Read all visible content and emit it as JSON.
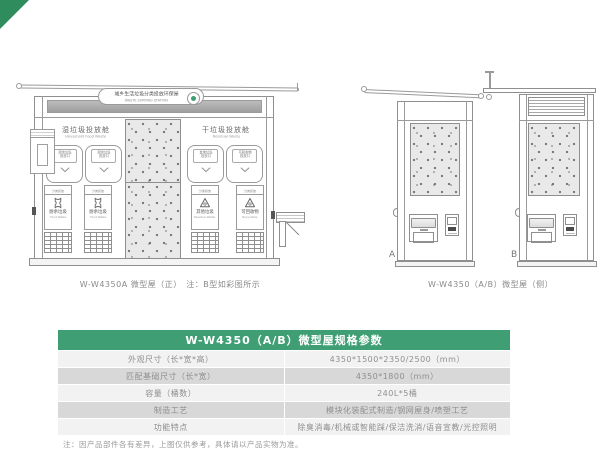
{
  "colors": {
    "accent_green": "#3f9e73",
    "corner_green": "#2f8c5c"
  },
  "drawing": {
    "front_view": {
      "sign": {
        "title": "城乡生活垃圾分类投放环保屋",
        "subtitle": "WASTE SORTING STATION"
      },
      "sections": [
        {
          "title": "湿垃圾投放舱",
          "subtitle": "Household Food Waste"
        },
        {
          "title": "干垃圾投放舱",
          "subtitle": "Residual Waste"
        }
      ],
      "doors": [
        "厨余垃圾投放口",
        "厨余垃圾投放口",
        "其他垃圾投放口",
        "可回收物投放口"
      ],
      "bins": [
        {
          "header": "分类投放",
          "name": "厨余垃圾",
          "name_en": "Food Waste"
        },
        {
          "header": "分类投放",
          "name": "厨余垃圾",
          "name_en": "Food Waste"
        },
        {
          "header": "分类投放",
          "name": "其他垃圾",
          "name_en": "Residual Waste"
        },
        {
          "header": "分类投放",
          "name": "可回收物",
          "name_en": "Recyclable"
        }
      ],
      "caption": "W-W4350A 微型屋（正）　注：B型如彩图所示"
    },
    "side_view": {
      "label_a": "A",
      "label_b": "B",
      "caption": "W-W4350（A/B）微型屋（侧）"
    }
  },
  "spec_table": {
    "title": "W-W4350（A/B）微型屋规格参数",
    "rows": [
      {
        "label": "外观尺寸（长*宽*高）",
        "value": "4350*1500*2350/2500（mm）"
      },
      {
        "label": "匹配基础尺寸（长*宽）",
        "value": "4350*1800（mm）"
      },
      {
        "label": "容量（桶数）",
        "value": "240L*5桶"
      },
      {
        "label": "制造工艺",
        "value": "模块化装配式制造/钢网屋身/喷塑工艺"
      },
      {
        "label": "功能特点",
        "value": "除臭消毒/机械或智能踩/保洁洗消/语音宣教/光控照明"
      }
    ]
  },
  "footnote": "注：因产品部件各有差异，上图仅供参考，具体请以产品实物为准。"
}
